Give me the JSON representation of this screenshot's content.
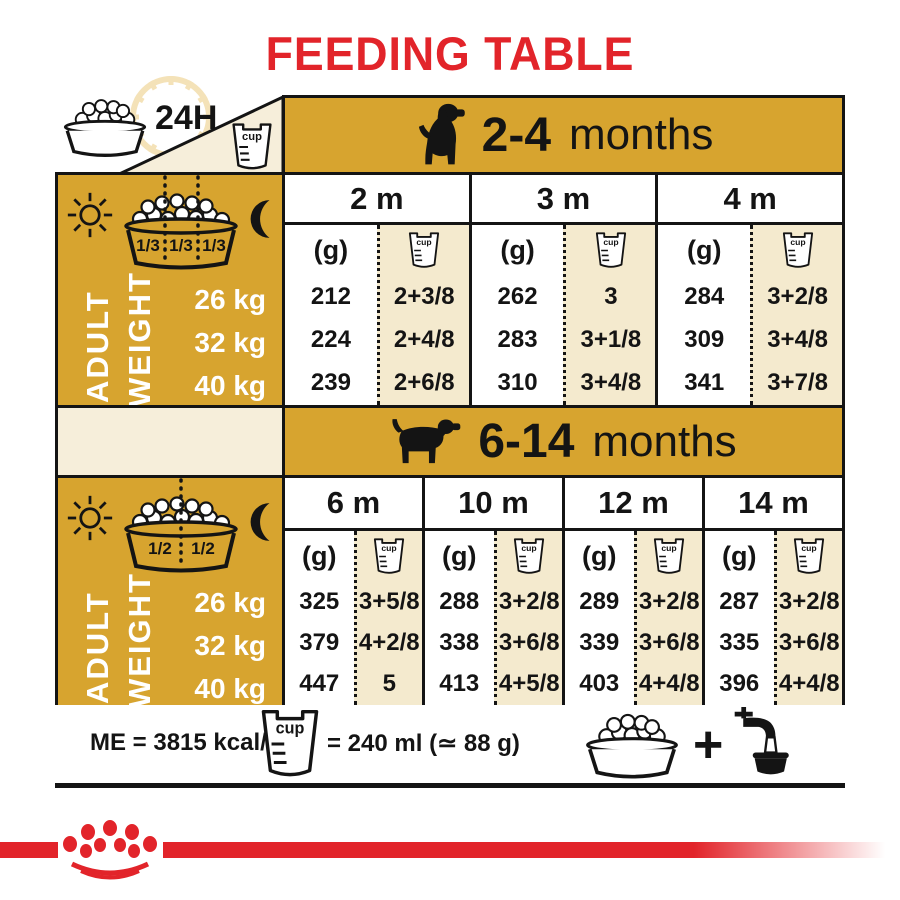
{
  "colors": {
    "gold": "#D7A42F",
    "cream": "#F6EEDA",
    "beige": "#F4EACE",
    "red": "#E2242A",
    "ink": "#141414",
    "faint": "#F4E2B8"
  },
  "title": "FEEDING TABLE",
  "labels": {
    "h24": "24H",
    "g": "(g)",
    "cup": "cup"
  },
  "sidebar": {
    "adult": "ADULT",
    "weight": "WEIGHT",
    "weights": [
      "26 kg",
      "32 kg",
      "40 kg"
    ],
    "portions1": [
      "1/3",
      "1/3",
      "1/3"
    ],
    "portions2": [
      "1/2",
      "1/2"
    ]
  },
  "tables": [
    {
      "age_bold": "2-4",
      "age_word": "months",
      "columns": [
        {
          "month": "2 m",
          "g": [
            "212",
            "224",
            "239"
          ],
          "cups": [
            "2+3/8",
            "2+4/8",
            "2+6/8"
          ]
        },
        {
          "month": "3 m",
          "g": [
            "262",
            "283",
            "310"
          ],
          "cups": [
            "3",
            "3+1/8",
            "3+4/8"
          ]
        },
        {
          "month": "4 m",
          "g": [
            "284",
            "309",
            "341"
          ],
          "cups": [
            "3+2/8",
            "3+4/8",
            "3+7/8"
          ]
        }
      ]
    },
    {
      "age_bold": "6-14",
      "age_word": "months",
      "columns": [
        {
          "month": "6 m",
          "g": [
            "325",
            "379",
            "447"
          ],
          "cups": [
            "3+5/8",
            "4+2/8",
            "5"
          ]
        },
        {
          "month": "10 m",
          "g": [
            "288",
            "338",
            "413"
          ],
          "cups": [
            "3+2/8",
            "3+6/8",
            "4+5/8"
          ]
        },
        {
          "month": "12 m",
          "g": [
            "289",
            "339",
            "403"
          ],
          "cups": [
            "3+2/8",
            "3+6/8",
            "4+4/8"
          ]
        },
        {
          "month": "14 m",
          "g": [
            "287",
            "335",
            "396"
          ],
          "cups": [
            "3+2/8",
            "3+6/8",
            "4+4/8"
          ]
        }
      ]
    }
  ],
  "footer": {
    "me": "ME = 3815 kcal/kg",
    "cup_equiv": "= 240 ml (≃ 88 g)",
    "plus": "+"
  }
}
